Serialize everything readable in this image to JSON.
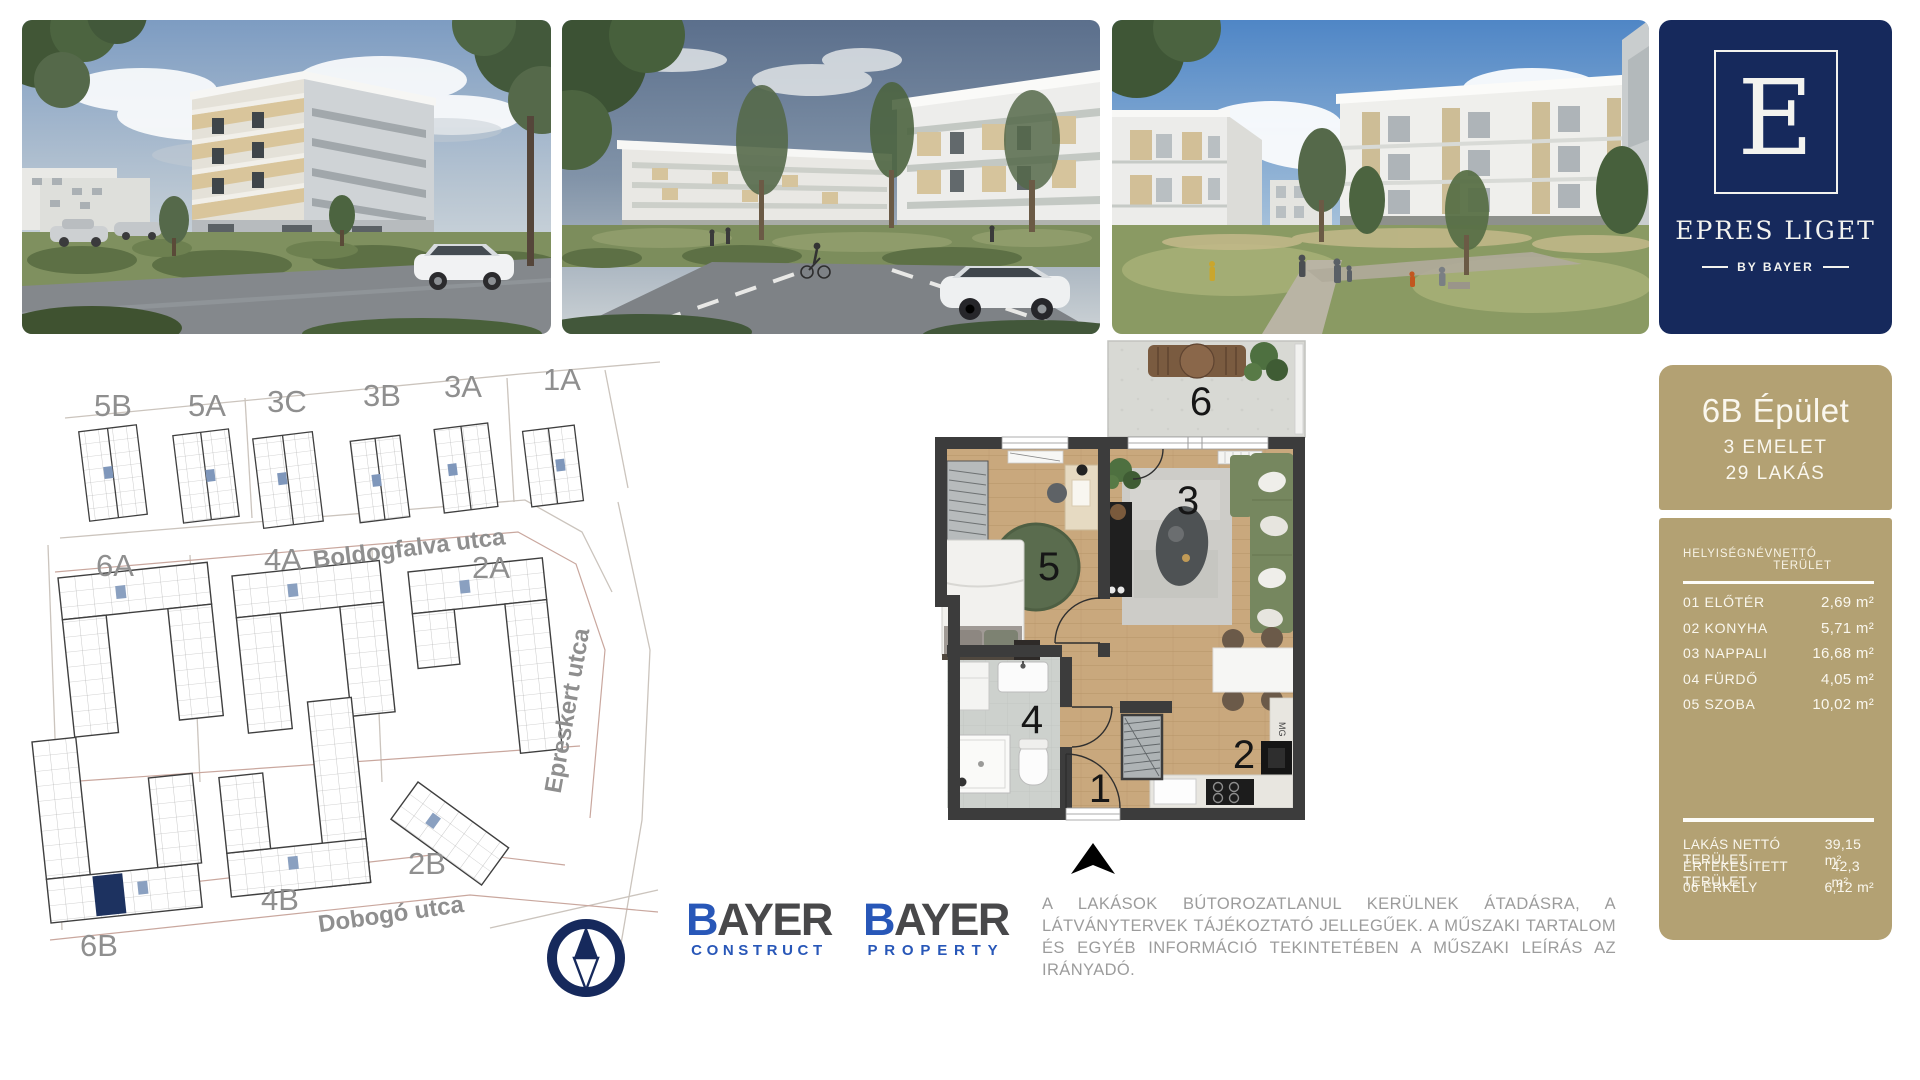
{
  "branding": {
    "logo_letter": "E",
    "project_name": "EPRES LIGET",
    "byline": "BY BAYER",
    "navy": "#16295c",
    "tan": "#b3a173",
    "bayer_blue": "#2857b8",
    "bayer_gray": "#48484a"
  },
  "photos": [
    {
      "name": "building-corner-render"
    },
    {
      "name": "street-view-render"
    },
    {
      "name": "courtyard-render"
    }
  ],
  "siteplan": {
    "street_names": {
      "top": "Boldogfalva utca",
      "right": "Epreskert utca",
      "bottom": "Dobogó utca"
    },
    "top_buildings": [
      "5B",
      "5A",
      "3C",
      "3B",
      "3A",
      "1A"
    ],
    "bottom_buildings": [
      "6A",
      "4A",
      "2A",
      "2B",
      "4B",
      "6B"
    ],
    "highlight_color": "#1d3260"
  },
  "floorplan": {
    "rooms": [
      "1",
      "2",
      "3",
      "4",
      "5",
      "6"
    ],
    "fridge_label": "MG"
  },
  "panel": {
    "title": "6B Épület",
    "floors": "3 EMELET",
    "apartments": "29 LAKÁS",
    "col_name": "HELYISÉGNÉV",
    "col_area": "NETTÓ TERÜLET",
    "rows": [
      {
        "name": "01 ELŐTÉR",
        "area": "2,69 m²"
      },
      {
        "name": "02 KONYHA",
        "area": "5,71 m²"
      },
      {
        "name": "03 NAPPALI",
        "area": "16,68 m²"
      },
      {
        "name": "04 FÜRDŐ",
        "area": "4,05 m²"
      },
      {
        "name": "05 SZOBA",
        "area": "10,02 m²"
      }
    ],
    "summary": [
      {
        "name": "LAKÁS NETTÓ TERÜLET",
        "area": "39,15 m²"
      },
      {
        "name": "ÉRTÉKESÍTETT TERÜLET",
        "area": "42,3 m²"
      },
      {
        "name": "06 ERKÉLY",
        "area": "6,12 m²"
      }
    ]
  },
  "footer": {
    "logos": [
      {
        "initial": "B",
        "rest": "AYER",
        "sub": "CONSTRUCT"
      },
      {
        "initial": "B",
        "rest": "AYER",
        "sub": "PROPERTY"
      }
    ],
    "disclaimer": "A LAKÁSOK BÚTOROZATLANUL KERÜLNEK ÁTADÁSRA, A LÁTVÁNYTERVEK TÁJÉKOZTATÓ JELLEGŰEK. A MŰSZAKI TARTALOM ÉS EGYÉB INFORMÁCIÓ TEKINTETÉBEN A MŰSZAKI LEÍRÁS AZ IRÁNYADÓ."
  }
}
